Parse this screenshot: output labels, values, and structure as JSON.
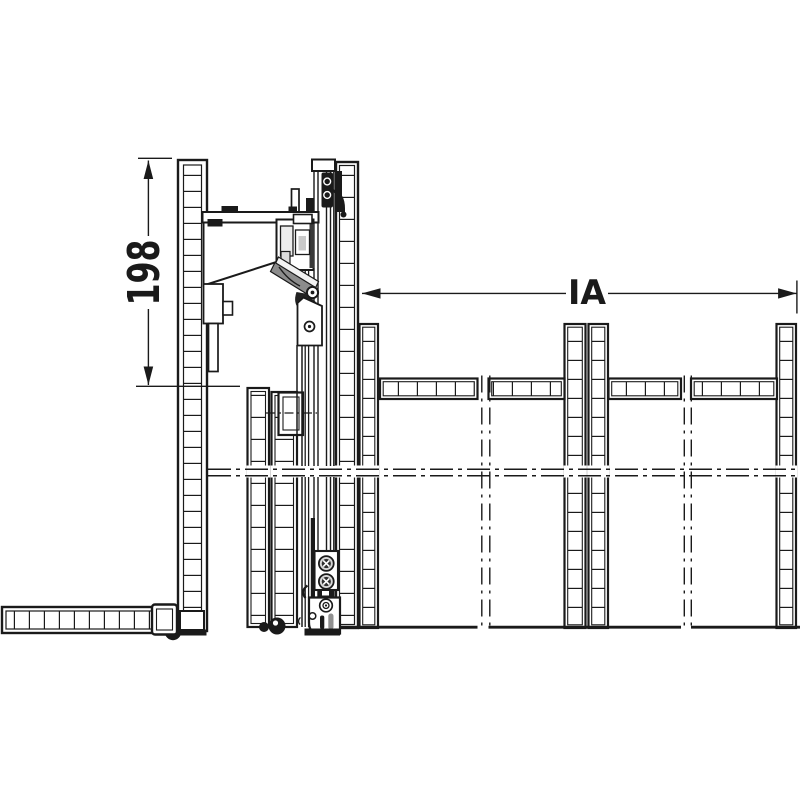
{
  "drawing": {
    "type": "technical-installation-diagram",
    "colors": {
      "background": "#ffffff",
      "line": "#1a1a1a",
      "dark_fill": "#1a1a1a",
      "light_fill": "#ececec"
    },
    "labels": {
      "height_dimension": "198",
      "inner_width_dimension": "IA"
    },
    "components": [
      "left-cabinet-side-panel",
      "open-door-panel-horizontal",
      "folded-door-panels",
      "front-door-panel",
      "vertical-guide-rail",
      "top-folding-fitting",
      "bottom-guide-bracket",
      "cabinet-posts",
      "shelves",
      "center-lines"
    ]
  }
}
